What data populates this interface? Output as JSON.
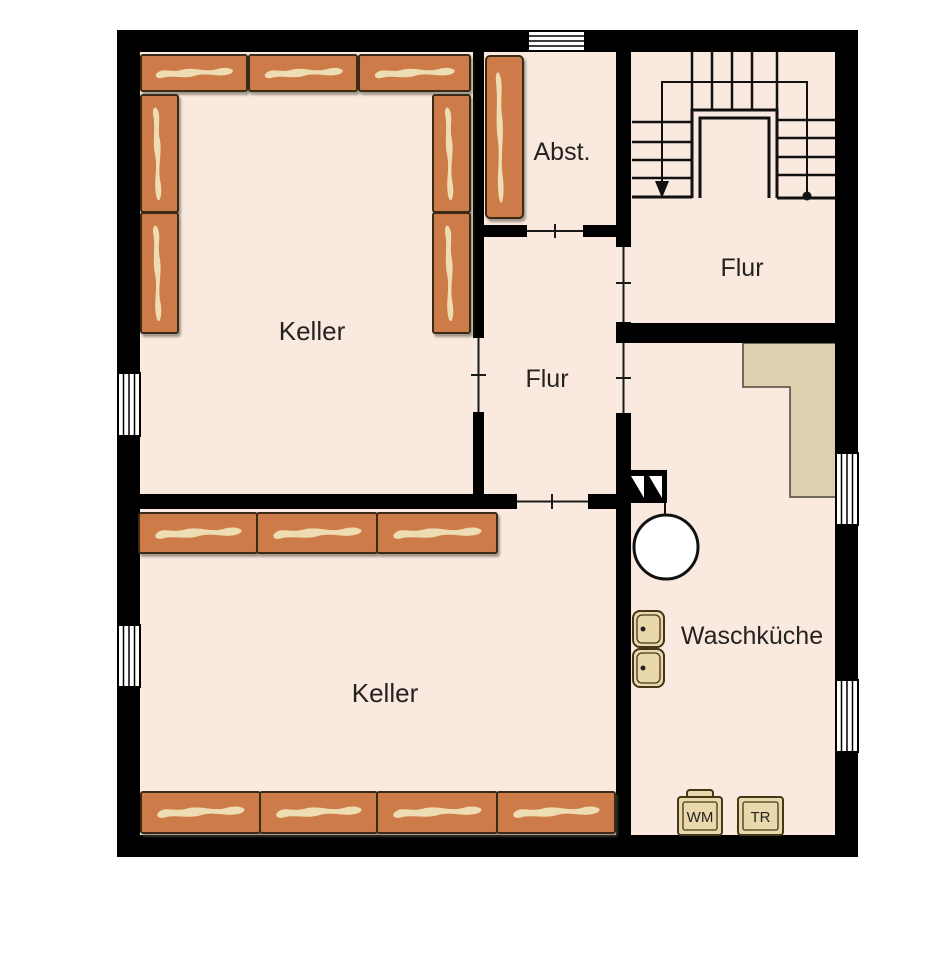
{
  "floorplan": {
    "type": "basement-floor-plan",
    "rooms": {
      "keller_upper": "Keller",
      "abstellraum": "Abst.",
      "flur_upper": "Flur",
      "flur_middle": "Flur",
      "keller_lower": "Keller",
      "waschkueche": "Waschküche"
    },
    "appliances": {
      "washing_machine": "WM",
      "dryer": "TR"
    },
    "symbols": {
      "stairs": "stairs-icon",
      "stair_direction": "stair-down-arrow-icon",
      "stair_start": "stair-start-dot-icon",
      "boiler": "boiler-tank-icon",
      "sinks": "laundry-sink-icon",
      "meter_boxes": "electric-meter-icon",
      "windows": "window-icon",
      "shelving": "storage-shelf-icon",
      "overhang": "overhang-area"
    },
    "colors": {
      "wall": "#000000",
      "floor": "#f9e9df",
      "shelf": "#cd7c4a",
      "shelf_plank": "#eedcb2",
      "overhang_area": "#ddd0ae",
      "appliance": "#e9d8ab",
      "background": "#ffffff",
      "label_text": "#262220"
    }
  }
}
